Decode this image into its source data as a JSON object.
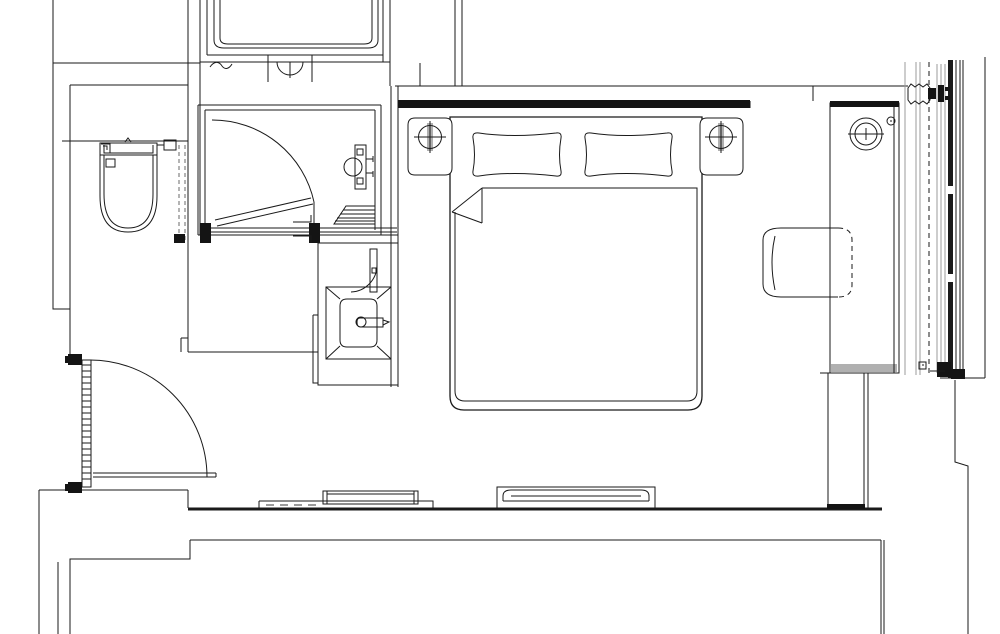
{
  "meta": {
    "drawing_type": "architectural floor plan (hotel guestroom)",
    "canvas": {
      "width": 1000,
      "height": 634,
      "background": "#ffffff"
    },
    "colors": {
      "line": "#1a1a1a",
      "gray_line": "#9b9b9b",
      "black_fill": "#141414",
      "gray_fill": "#b0b0b0",
      "background": "#ffffff"
    },
    "fixtures": [
      "toilet",
      "shower-enclosure",
      "shower-door",
      "shower-mixer",
      "shower-steps",
      "bathtub-adjacent-room",
      "tub-faucet-symbol",
      "vanity-sink",
      "vanity-faucet",
      "entry-door",
      "double-bed",
      "pillows",
      "duvet-fold",
      "nightstand-left",
      "nightstand-right",
      "table-lamps",
      "desk",
      "desk-lamp",
      "desk-chair",
      "wardrobe-panel",
      "curtain-wall-window",
      "wall-bench-left",
      "wall-bench-right"
    ]
  },
  "paths": {
    "outer_walls": "M53,0 V309 H70 M70,85 V356 M70,487 V491 M53,63 H200 M70,85 H188 M62,141 H188 M188,0 V352 M200,0 V235 M39,490 H188 M188,490 V508 M39,490 V634 M190,540 H881 M190,540 V559 H70 V634 M58,562 V634 M881,540 V634 M884,540 V634 M955,380 V462 L968,466 V634 M940,378 H985 M181,338 H188 M181,338 V352 M188,352 H318",
    "band_top": "M395,86 H908 M390,62 V86 M420,63 V86 M455,0 V86 M462,0 V86 M813,86 V101 M750,101 V108",
    "tub_room": "M200,0 V62 M207,0 V55 M383,0 V62 M390,0 V62 M200,62 H390 M207,55 H383 M214,0 V40 Q214,48 224,48 H368 Q378,48 378,40 V0 M220,0 V38 Q220,44 228,44 H364 Q372,44 372,38 V0 M210,67 c4,-6 9,-6 12,-1 c3,4 7,3 10,-2",
    "tub_faucet": "M268,55 V82 M312,55 V82 M268,55 H312 M268,62 H312 M277,62 A13,13 0 0 0 303,62 M290,62 V78",
    "shower_walls": "M198,105 H381 M205,110 H375 M198,105 V235 M205,110 V230 M375,110 V230 M381,105 V235 M198,235 H398 M202,228 H397 M202,232 H397 M391,86 V387 M398,86 V387",
    "shower_door": "M212,120 A104,104 0 0 1 314,202 M314,202 V226 M215,220 L311,198 M217,226 L313,204",
    "shower_posts": "M200,223 H211 V243 H200 Z M309,223 H320 V243 H309 Z",
    "shower_brackets": "M293,222 H311 V215 M293,236 H311 V243",
    "shower_fixture": "M355,145 H366 V189 H355 Z M357,149 H363 V155 H357 Z M357,178 H363 V184 H357 Z M366,159 h7 M366,173 h7 M373,156 v6 M373,171 v6 M344,167 a9,9 0 1 0 18,0 a9,9 0 1 0 -18,0",
    "shower_steps": "M346,206 H375 V224 H334 Z M343,210 H375 M340,214 H375 M337,218 H375 M335,221 H375",
    "chase_dashed": "M179,145 V243 M185,145 V243",
    "chase_foot": "M174,234 H185 V243 H174 Z",
    "toilet": "M100,143 H157 V155 H100 Z M104,145 V153 H153 V145 M101,144 H110 V153 M103,146 H107 V150 M125,142 l3,-4 3,4 M100,155 V196 Q100,232 128,232 Q157,232 157,196 V155 M104,155 V194 Q104,228 128,228 Q153,228 153,194 V155 M106,159 H115 V167 H106 Z M157,145 H164 M164,140 H176 V150 H164 Z",
    "vanity": "M398,243 H318 V385 H398 M313,315 H318 M313,315 V383 H318 M326,287 H391 V359 H326 Z M326,287 L340,299 M391,287 L377,299 M326,359 L340,346 M391,359 L377,346 M340,306 Q340,299 347,299 H370 Q377,299 377,306 V340 Q377,347 370,347 H347 Q340,347 340,340 Z M370,249 H377 V292 H370 Z M372,268 h4 v5 h-4 Z M351,292 A27,27 0 0 0 377,265 M360,318 Q357,318 357,322 Q357,327 360,327 H383 V318 Z M383,320 l6,2 -6,3 M356,322 a5,5 0 1 0 10,0 a5,5 0 1 0 -10,0",
    "entry_leaf": "M82,360 H91 V487 H82 Z",
    "entry_hatch": "M82,365 H91 M82,371 H91 M82,377 H91 M82,383 H91 M82,389 H91 M82,395 H91 M82,401 H91 M82,407 H91 M82,413 H91 M82,419 H91 M82,425 H91 M82,431 H91 M82,437 H91 M82,443 H91 M82,449 H91 M82,455 H91 M82,461 H91 M82,467 H91 M82,473 H91 M82,479 H91",
    "entry_hinges": "M68,354 H82 V365 H68 Z M68,482 H82 V493 H68 Z M65,356 h5 v7 h-5 Z M65,484 h5 v7 h-5 Z",
    "entry_arc": "M90,360 A117,117 0 0 1 207,477",
    "entry_threshold": "M93,473 H216 M93,477 H216 M216,473 V477",
    "south_wall": "M188,509 H882",
    "bench_left": "M259,501 H433 V509 M259,501 V509 M323,491 H418 V504 H323 Z M327,494 H414 M327,491 V504 M414,491 V504",
    "bench_left_dashes": "M266,505 h8 M280,505 h8 M294,505 h8 M308,505 h8",
    "bench_right": "M497,487 H655 V508 H497 Z M503,501 V496 Q503,490 511,490 H641 Q649,490 649,496 V501 M503,501 H649 M511,496 H641",
    "bed": "M450,117 H702 V396 Q702,410 688,410 H464 Q450,410 450,396 Z",
    "blanket": "M482,188 H697 V391 Q697,401 687,401 H465 Q455,401 455,391 V212 M482,188 V223 M482,188 L452,212 M452,212 L482,223",
    "pillows": "M473,138 Q472,132 479,133 Q512,138 556,133 Q562,132 561,138 Q558,155 561,171 Q562,177 556,176 Q512,171 479,176 Q472,177 473,171 Q476,155 473,138 Z M585,138 Q584,132 591,133 Q624,138 667,133 Q673,132 672,138 Q669,155 672,171 Q673,177 667,176 Q624,171 591,176 Q584,177 585,171 Q588,155 585,138 Z",
    "nightstands": "M415,118 H445 Q452,118 452,125 V168 Q452,175 445,175 H415 Q408,175 408,168 V125 Q408,118 415,118 Z M707,118 H736 Q743,118 743,125 V168 Q743,175 736,175 H707 Q700,175 700,168 V125 Q700,118 707,118 Z",
    "lamp_stems": "M427,123 H433 V151 H427 Z M718,123 H724 V151 H718 Z",
    "lamp_cross": "M414,137 H446 M430,121 V153 M705,137 H737 M721,121 V153",
    "lamp_circles": "M418.5,137 a11.5,11.5 0 1 0 23,0 a11.5,11.5 0 1 0 -23,0 M709.5,137 a11.5,11.5 0 1 0 23,0 a11.5,11.5 0 1 0 -23,0",
    "headboard": "M398,100 H750 V108 H398 Z",
    "desk": "M830,103 H899 V373 H830 Z M894,107 V373 M820,373 H830",
    "desk_top": "M830,101 H899 V107 H830 Z",
    "desk_gray": "M831,364 H897 V372 H831 Z",
    "desk_lamp": "M850,134 a16,16 0 1 0 32,0 a16,16 0 1 0 -32,0 M855,134 a11,11 0 1 0 22,0 a11,11 0 1 0 -22,0 M848,134 H884 M866,128 V140 M862,134 h8",
    "desk_dot": "M887,121 a4,4 0 1 0 8,0 a4,4 0 1 0 -8,0 M890,121 h2",
    "chair_solid": "M838,228 H781 Q763,228 763,240 V284 Q763,297 781,297 H838 M775,236 Q769,262 775,290",
    "chair_dashed": "M838,228 Q852,228 852,240 V285 Q852,297 838,297",
    "wardrobe": "M828,373 H864 V504 M828,373 V504 M868,373 V508",
    "wardrobe_foot": "M827,504 H865 V509 H827 Z",
    "window_gray": "M905,62 V375 M916,62 V375 M920,62 V375 M937,64 V373 M941,64 V373 M945,64 V373",
    "window_dashed": "M929,62 V373",
    "window_bar": "M950.5,60 V186 M950.5,194 V274 M950.5,282 V378",
    "window_black": "M956,60 V378 M960,60 V378 M963,60 V378",
    "window_outer": "M985,57 V378",
    "window_break": "M908,88 l3,-4 4,3 4,-3 4,3 4,-3 3,4 v12 l-3,4 -4,-3 -4,3 -4,-3 -4,3 -3,-4 Z",
    "window_top_conn": "M928,88 H936 V99 H928 Z M938,85 H944 V102 H938 Z M945,87 h5 v4 h-5 Z M945,96 h5 v4 h-5 Z",
    "window_bot_conn": "M937,362 H951 V377 H937 Z M951,369 H965 V379 H951 Z",
    "window_bot_misc": "M930,371 H945 M919,362 H926 V369 H919 Z M922,365 h2"
  }
}
